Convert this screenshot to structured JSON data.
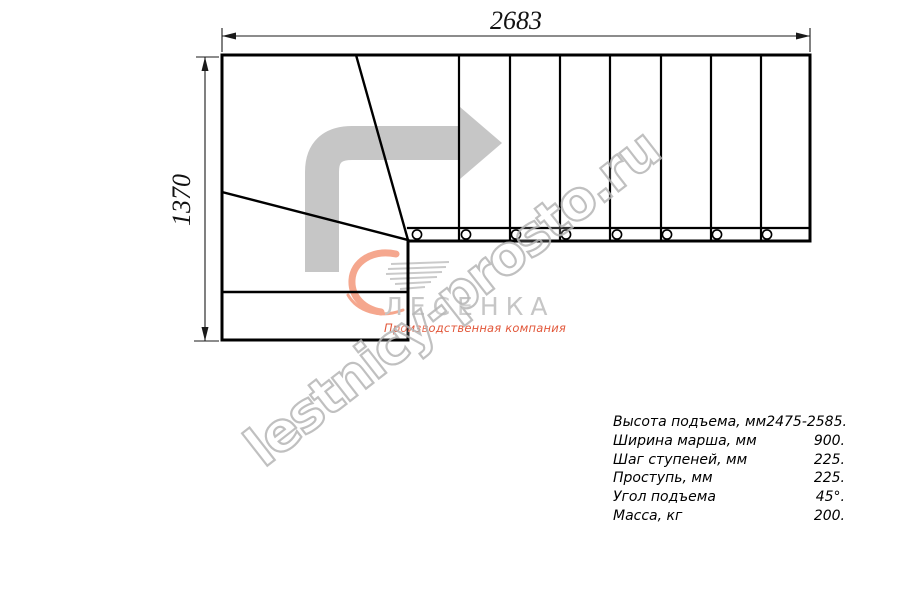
{
  "drawing": {
    "title_hint": "staircase-plan-top-view",
    "straight_treads": 8,
    "winder_treads": 2,
    "landing_steps": 2,
    "balusters": 8,
    "line_color": "#000000",
    "dimension_line_color": "#1a1a1a",
    "direction_arrow_color": "#c6c6c6"
  },
  "dimensions": {
    "width_label": "2683",
    "height_label": "1370"
  },
  "watermark": {
    "text": "lestnicy-prosto.ru",
    "outline_color": "#b6b6b6"
  },
  "logo": {
    "name": "ЛЕСЕНКА",
    "tagline": "Производственная компания",
    "name_color": "#c6c6c6",
    "tagline_color": "#e2573a",
    "swirl_color": "#f5a78e",
    "swirl_icon": "swoosh-icon"
  },
  "specs": {
    "rows": [
      {
        "label": "Высота подъема, мм",
        "value": "2475-2585."
      },
      {
        "label": "Ширина марша, мм",
        "value": "900."
      },
      {
        "label": "Шаг ступеней, мм",
        "value": "225."
      },
      {
        "label": "Проступь, мм",
        "value": "225."
      },
      {
        "label": "Угол подъема",
        "value": "45°."
      },
      {
        "label": "Масса, кг",
        "value": "200."
      }
    ]
  }
}
